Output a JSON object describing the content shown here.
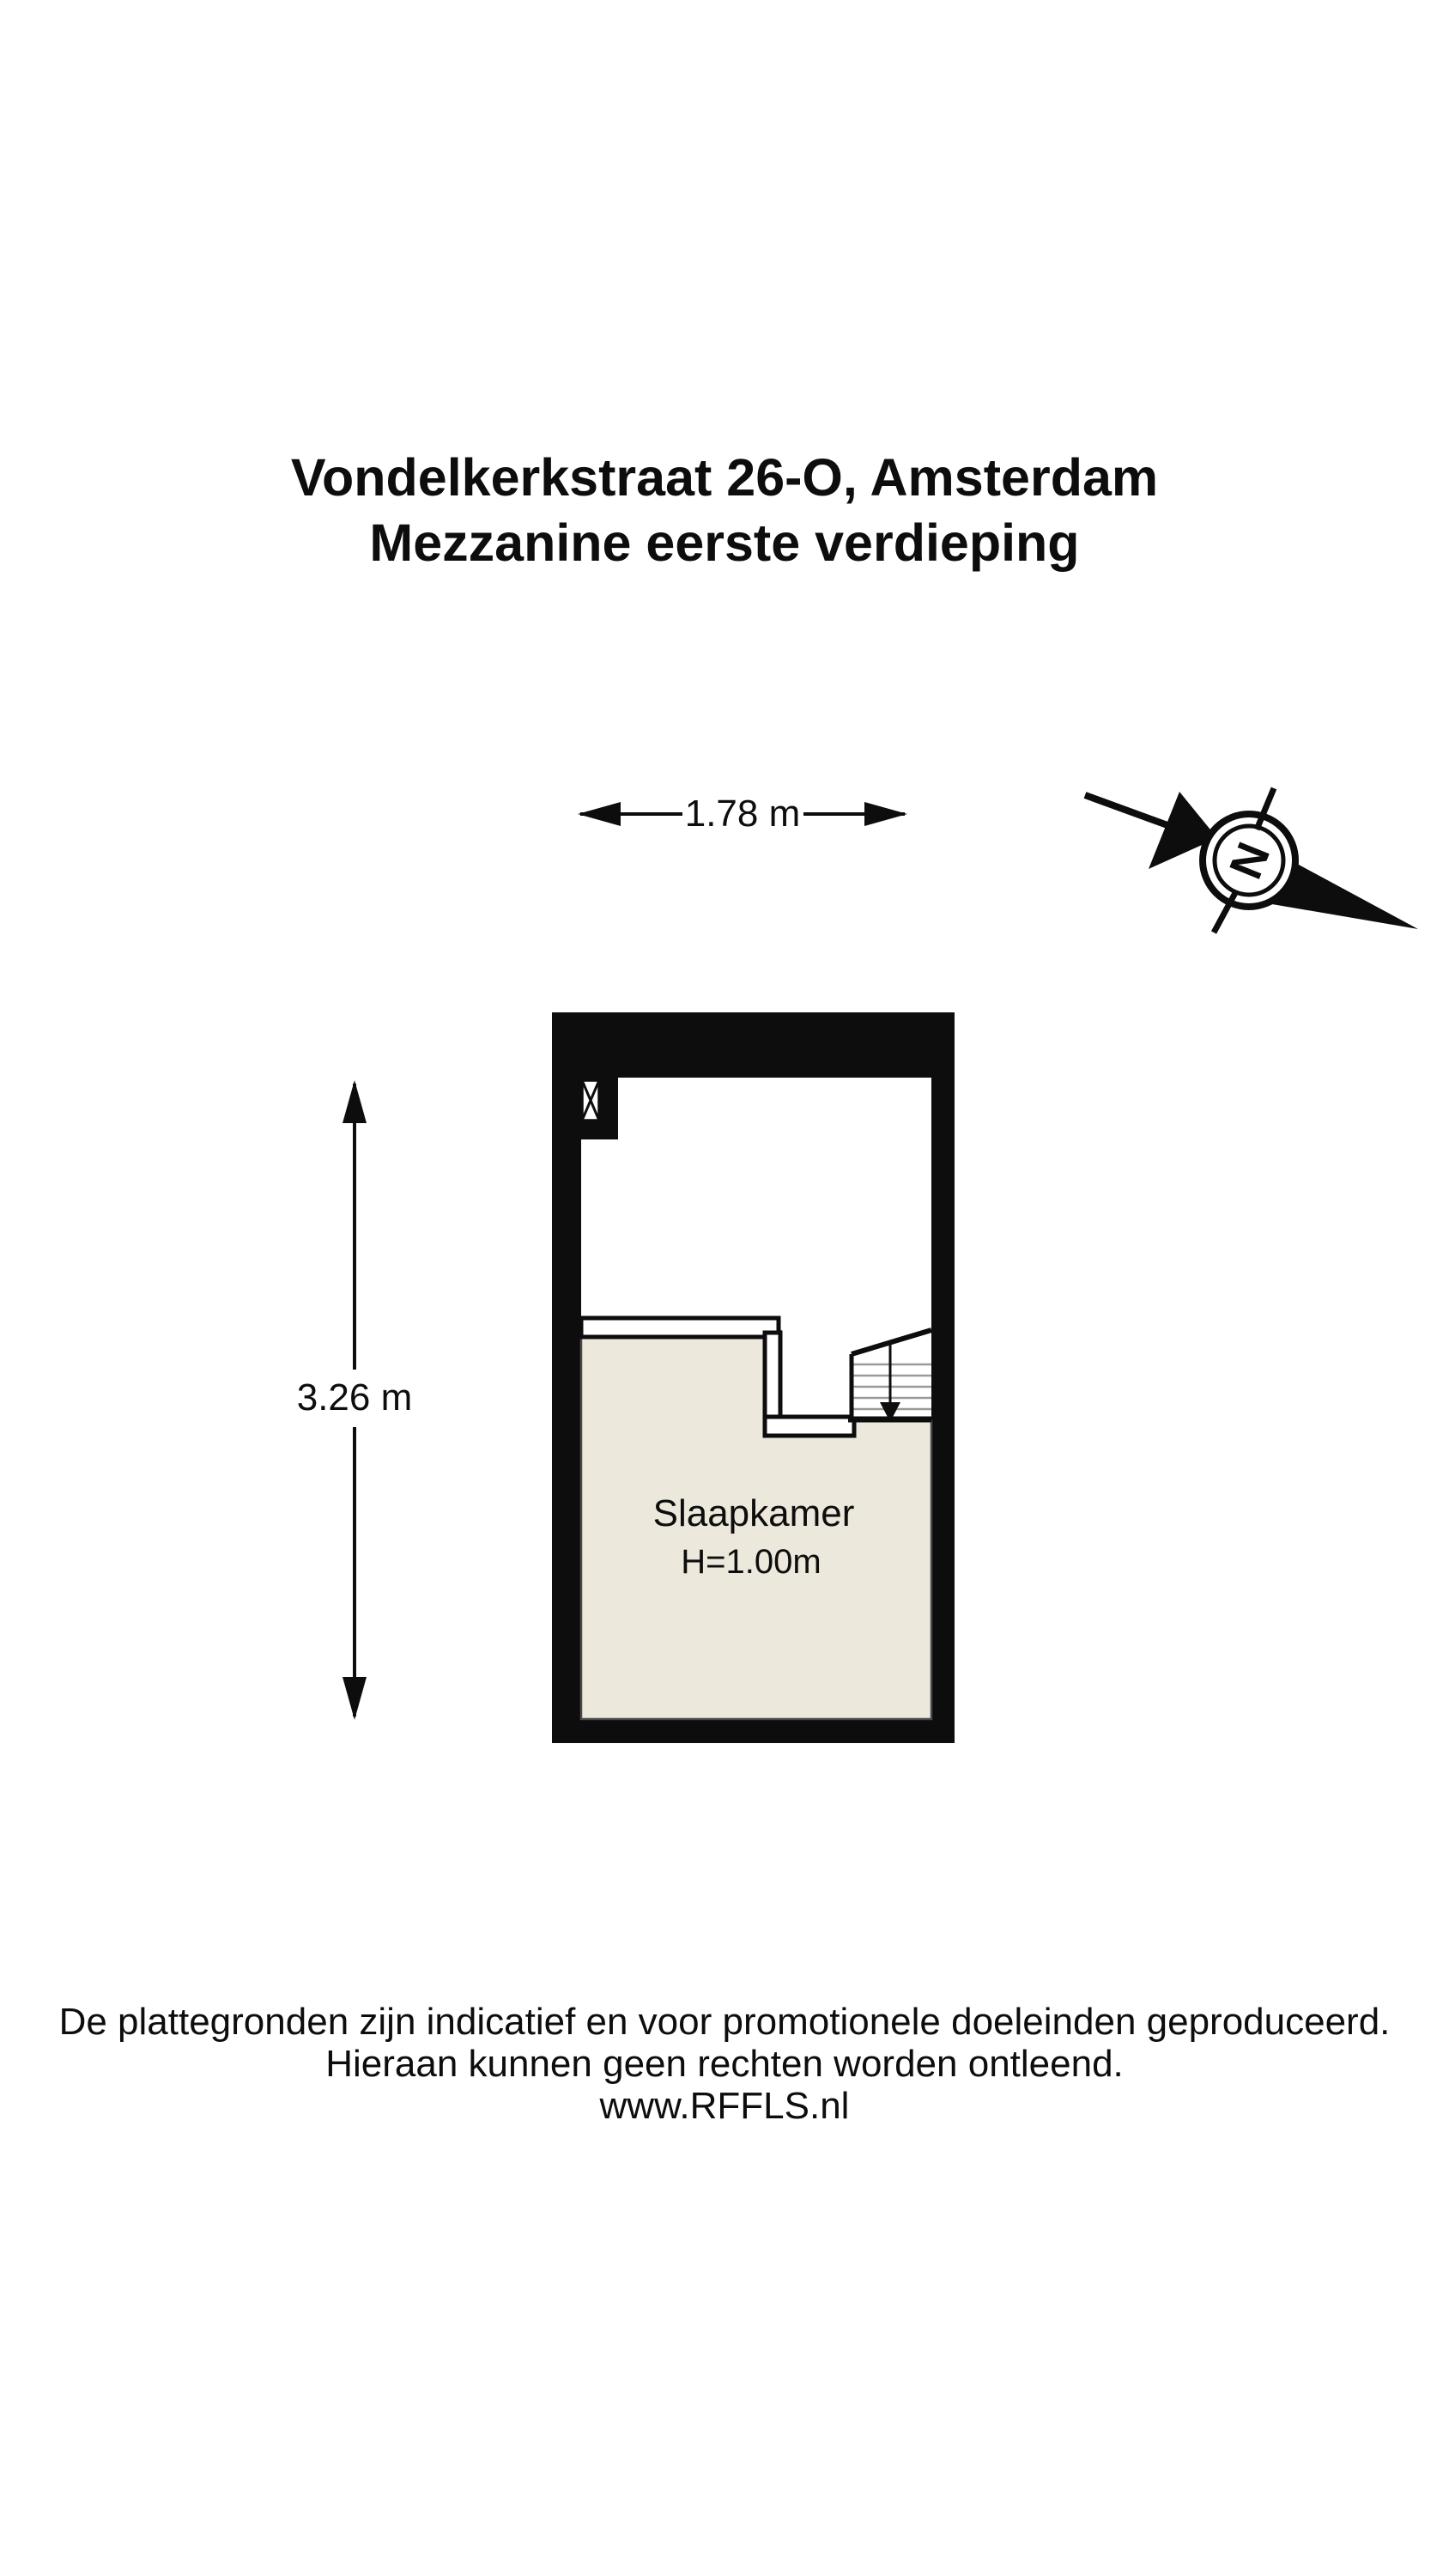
{
  "title": {
    "line1": "Vondelkerkstraat 26-O, Amsterdam",
    "line2": "Mezzanine eerste verdieping"
  },
  "compass": {
    "north_label": "N"
  },
  "dimensions": {
    "width_label": "1.78 m",
    "height_label": "3.26 m"
  },
  "room": {
    "name": "Slaapkamer",
    "ceiling_height_label": "H=1.00m"
  },
  "footer": {
    "line1": "De plattegronden zijn indicatief en voor promotionele doeleinden geproduceerd.",
    "line2": "Hieraan kunnen geen rechten worden ontleend.",
    "line3": "www.RFFLS.nl"
  },
  "colors": {
    "wall_black": "#0d0d0d",
    "floor_beige": "#ece8db",
    "floor_outline_gray": "#4a4a4a",
    "stair_tread_gray": "#9a9a9a"
  }
}
